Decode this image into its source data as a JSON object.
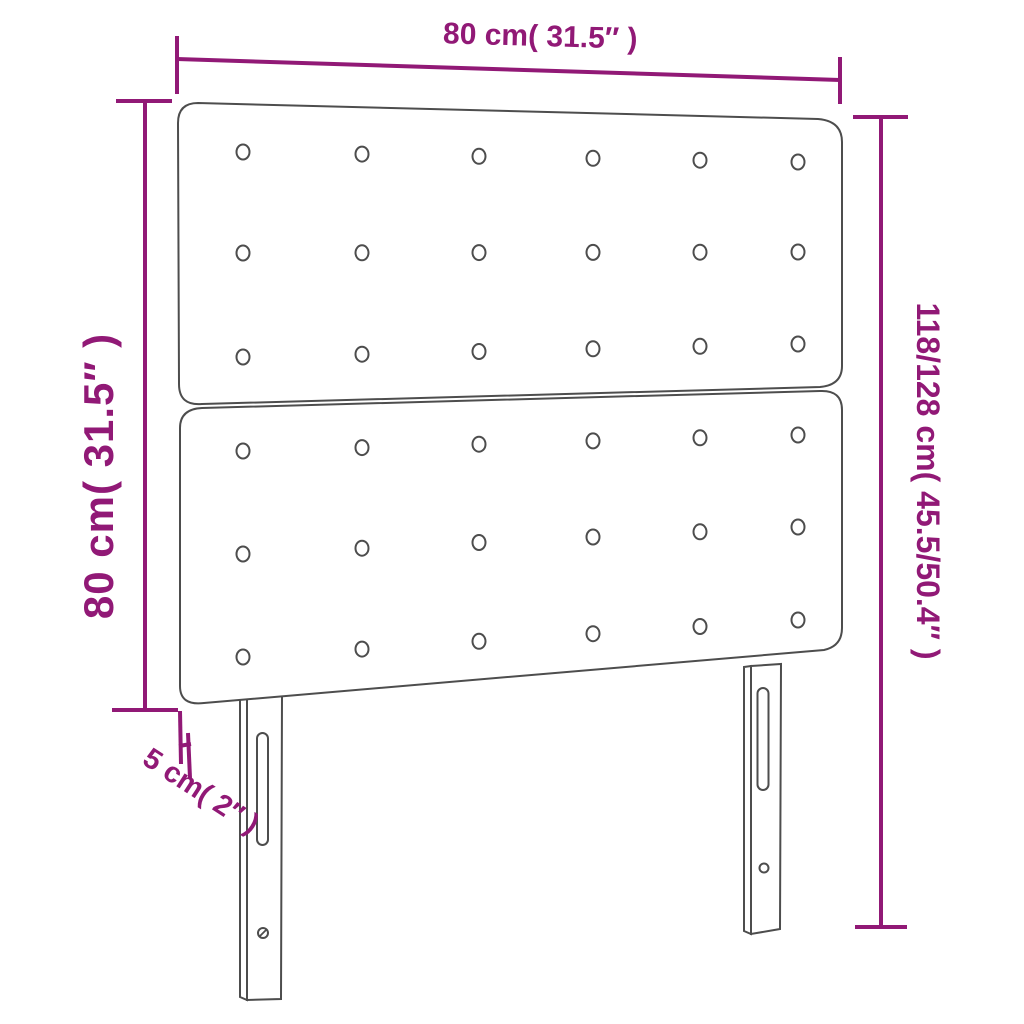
{
  "diagram": {
    "kind": "product-dimension-drawing",
    "product": "upholstered headboard with tufted buttons and two slotted legs",
    "background_color": "#ffffff",
    "outline_color": "#4d4d4d",
    "dimension_color": "#911976",
    "dimensions": {
      "width": {
        "label": "80 cm( 31.5″ )",
        "position": "top"
      },
      "panel_height": {
        "label": "80 cm( 31.5″ )",
        "position": "left"
      },
      "total_height": {
        "label": "118/128 cm( 45.5/50.4″ )",
        "position": "right"
      },
      "thickness": {
        "label": "5 cm( 2″ )",
        "position": "bottom-left"
      }
    },
    "structure": {
      "panels": 2,
      "button_grid_per_panel": "6 × 3",
      "buttons_total": 36,
      "legs": 2,
      "leg_features": "adjustment slot and screw hole"
    }
  }
}
